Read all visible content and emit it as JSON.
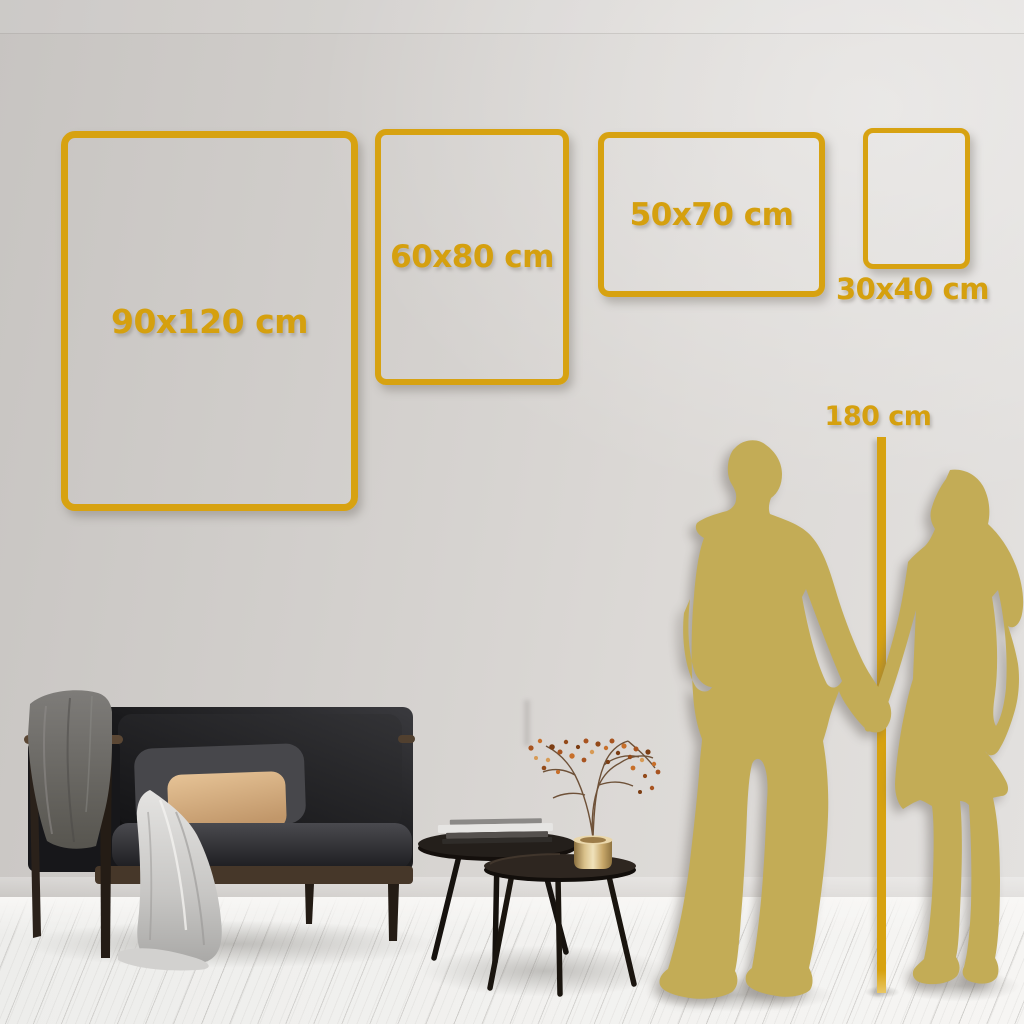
{
  "meta": {
    "title": "Poster size guide wall mockup"
  },
  "palette": {
    "accent_gold": "#d7a211",
    "label_gold": "#d5a00f",
    "silhouette_gold": "#c3ac56",
    "wall_gray": "#d6d3d0",
    "floor_white": "#f2f1ef"
  },
  "sizes": [
    {
      "label": "90x120 cm",
      "width_cm": 90,
      "height_cm": 120
    },
    {
      "label": "60x80 cm",
      "width_cm": 60,
      "height_cm": 80
    },
    {
      "label": "50x70 cm",
      "width_cm": 50,
      "height_cm": 70
    },
    {
      "label": "30x40 cm",
      "width_cm": 30,
      "height_cm": 40
    }
  ],
  "height_reference": {
    "label": "180 cm",
    "value_cm": 180
  }
}
